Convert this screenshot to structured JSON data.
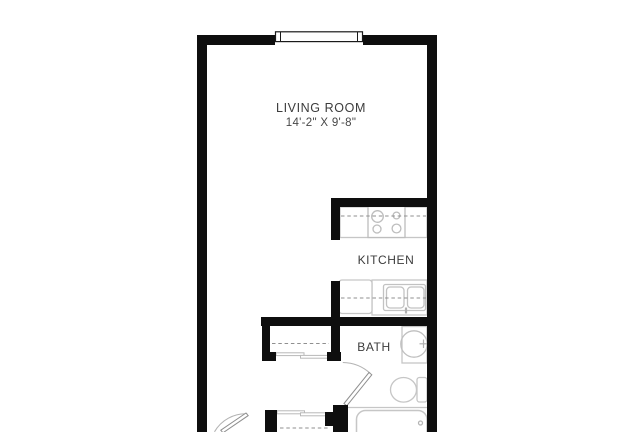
{
  "title": "Studio apartment floor plan",
  "rooms": {
    "living_room": {
      "label": "LIVING ROOM",
      "dimensions": "14'-2\" X 9'-8\""
    },
    "kitchen": {
      "label": "KITCHEN"
    },
    "bath": {
      "label": "BATH"
    }
  },
  "fixtures": [
    "window",
    "stove",
    "kitchen-counter",
    "refrigerator",
    "kitchen-sink",
    "closet",
    "closet-sliding-doors",
    "entry-door",
    "bath-door",
    "vanity-sink",
    "toilet",
    "bathtub"
  ],
  "colors": {
    "wall": "#0e0e0e",
    "fixture_stroke": "#c6c6c6",
    "dashed_line": "#8f8f8f",
    "text": "#3c3c3c",
    "background": "#ffffff"
  }
}
